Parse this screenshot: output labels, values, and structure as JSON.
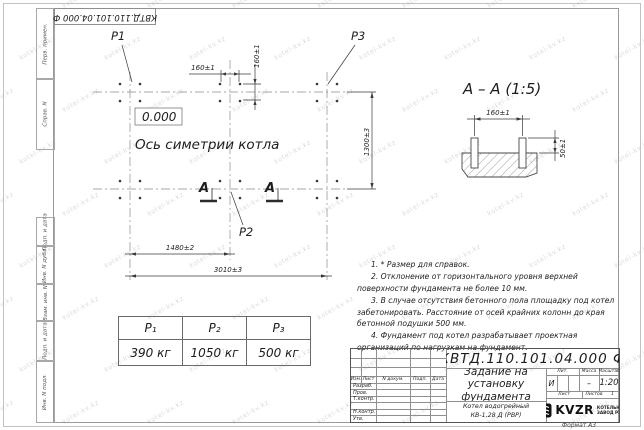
{
  "sheet": {
    "top_designation": "КВТД.110.101.04.000 Ф",
    "format_label": "Формат А3"
  },
  "margin_labels": {
    "perv_primen": "Перв. примен.",
    "sprav_n": "Справ. N",
    "podp_data_1": "Подп. и дата",
    "inv_n_dubl": "Инв. N дубл.",
    "vzam_inv_n": "Взам. инв. N",
    "podp_data_2": "Подп. и дата",
    "inv_n_podl": "Инв. N подл."
  },
  "plan": {
    "labels": {
      "p1": "P1",
      "p2": "P2",
      "p3": "P3"
    },
    "elevation": "0.000",
    "axis_caption": "Ось симетрии котла",
    "section_letter_left": "А",
    "section_letter_right": "А",
    "dims": {
      "bolt_spacing_x": "160±1",
      "bolt_spacing_y": "160±1",
      "width": "1300±3",
      "half_length": "1480±2",
      "full_length": "3010±3"
    }
  },
  "section": {
    "title": "А – А (1:5)",
    "dims": {
      "bolt_spacing": "160±1",
      "protrusion": "50±1"
    }
  },
  "notes": {
    "items": [
      "1. * Размер для справок.",
      "2. Отклонение от горизонтального уровня верхней поверхности фундамента не более 10 мм.",
      "3. В случае отсутствия бетонного пола площадку под котел забетонировать. Расстояние от осей крайних колонн до края бетонной подушки 500 мм.",
      "4. Фундамент под котел разрабатывает проектная организаций по нагрузкам на фундамент."
    ]
  },
  "load_table": {
    "headers": [
      "P₁",
      "P₂",
      "P₃"
    ],
    "values": [
      "390 кг",
      "1050 кг",
      "500 кг"
    ]
  },
  "titleblock": {
    "designation": "КВТД.110.101.04.000 Ф",
    "doc_title": "Задание на установку фундамента",
    "product_line1": "Котел водогрейный",
    "product_line2": "КВ-1,28 Д (РВР)",
    "header_cells": [
      "Изм.",
      "Лист",
      "N докум.",
      "Подп.",
      "Дата"
    ],
    "staff_rows": [
      "Разраб.",
      "Пров.",
      "Т.контр.",
      "Н.контр.",
      "Утв."
    ],
    "lit_header": "Лит.",
    "lit_value": "И",
    "mass_header": "Масса",
    "mass_value": "–",
    "scale_header": "Масштаб",
    "scale_value": "1:20",
    "sheet_header": "Лист",
    "sheets_header": "Листов",
    "sheets_value": "1",
    "company": {
      "logo_text": "KVZR",
      "tagline_line1": "КОТЕЛЬНЫЙ",
      "tagline_line2": "ЗАВОД РЭП"
    }
  },
  "watermark": {
    "text": "kotel-kv.kz"
  },
  "colors": {
    "line": "#3a3a3a",
    "frame": "#9a9a9a",
    "text": "#222222",
    "watermark": "#dcdcdc"
  }
}
